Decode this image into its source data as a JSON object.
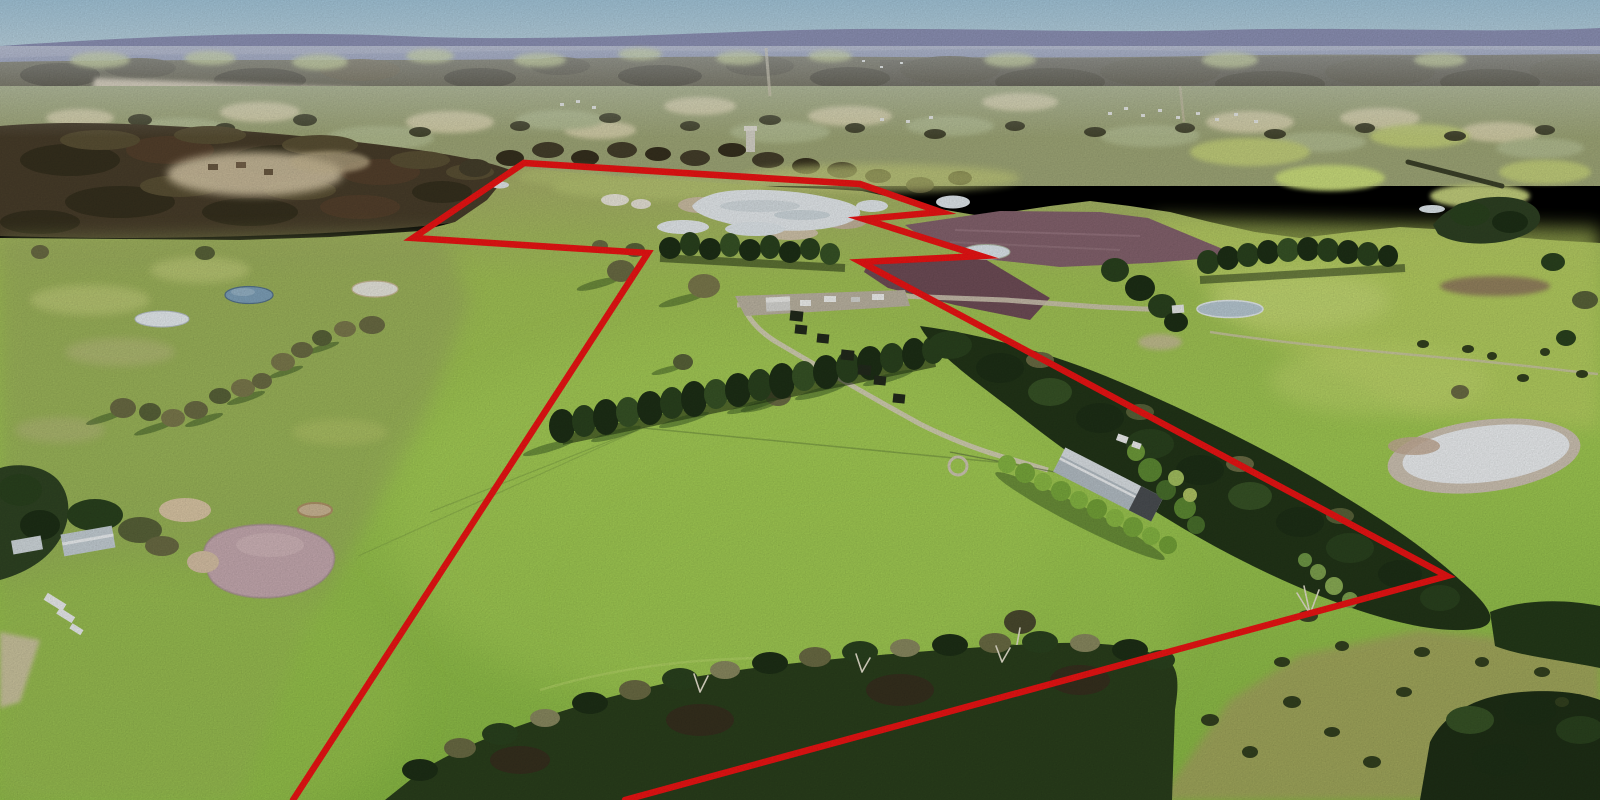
{
  "scene": {
    "type": "aerial-drone-photograph",
    "subject": "rural acreage property with red boundary outline overlay",
    "landmarks": [
      "large-white-dam-upper-centre",
      "farm-shed-with-hedge-row",
      "central-pine-windbreak",
      "ploughed-mauve-paddocks",
      "tan-dam-lower-left",
      "white-dam-right",
      "distant-hazy-ranges"
    ]
  },
  "boundary": {
    "color": "#ee1414",
    "stroke_width": 6.5,
    "miter_limit": 16,
    "points_str": "293,800 648,253 413,238 524,163 860,184 941,212 864,219 981,256 861,262 1447,576 625,800"
  },
  "palette": {
    "sky_top": "#a3c6da",
    "sky_horizon": "#c6dae4",
    "mountains_far": "#8d92b6",
    "mountains_near": "#7a82aa",
    "distant_band": "#565139",
    "sand_strip": "#d6c8ad",
    "valley_field": "#a0a878",
    "forest_upper_left": "#483d2a",
    "clearing": "#d2c3a2",
    "pasture_olive": "#a8ae6c",
    "pasture_bright": "#a0ca52",
    "pasture_deep": "#8abb45",
    "pine_dark": "#22361a",
    "plough_mauve": "#85636e",
    "plough_brown": "#6f4d57",
    "lake_white": "#e7ecef",
    "pond_blue": "#7fa2bb",
    "pond_tan": "#c7abb1",
    "road": "#cfc7b2",
    "shed_roof": "#b5bfc6",
    "hedge_green": "#8cbb45"
  }
}
